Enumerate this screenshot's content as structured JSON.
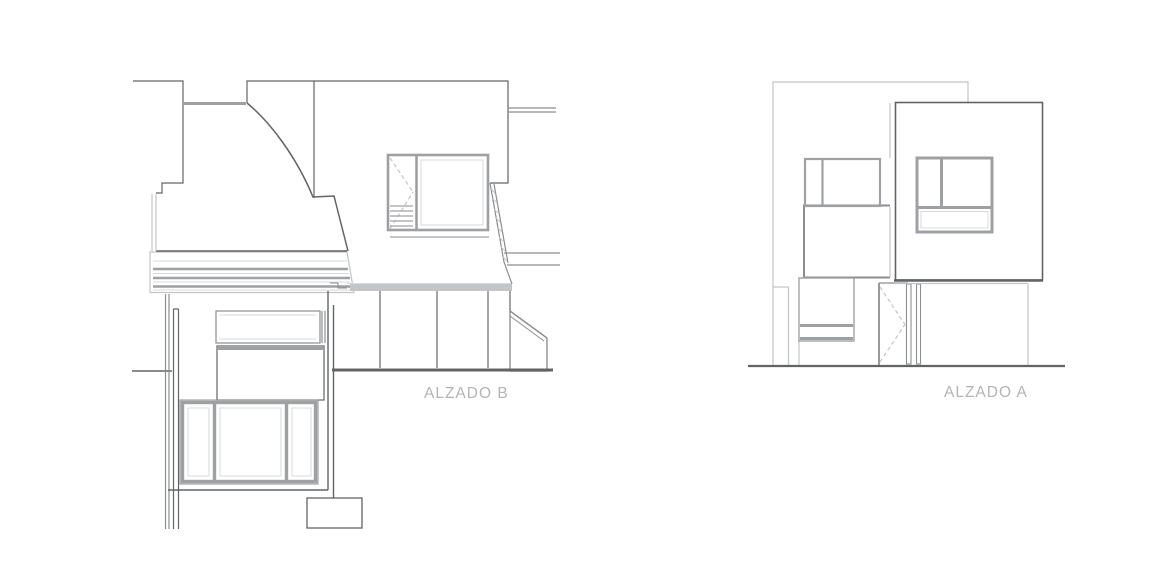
{
  "drawings": [
    {
      "id": "elevation-b",
      "label": "ALZADO B"
    },
    {
      "id": "elevation-a",
      "label": "ALZADO A"
    }
  ],
  "colors": {
    "background": "#ffffff",
    "line_dark": "#616467",
    "line_mid": "#8b8e91",
    "line_frame": "#9ea1a4",
    "line_light": "#c2c5c7",
    "line_faint": "#d7d9da",
    "label_text": "#b2b5b7",
    "hatch_dot": "#cfd1d2"
  }
}
